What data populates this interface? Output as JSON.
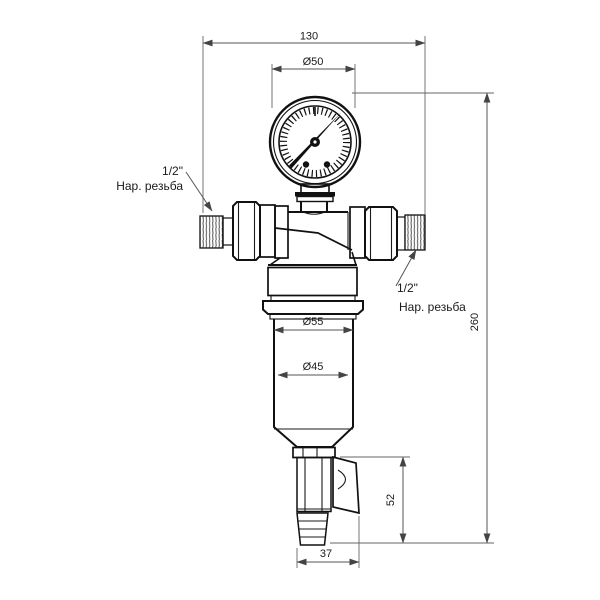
{
  "dimensions": {
    "overall_width": "130",
    "gauge_diameter": "Ø50",
    "overall_height": "260",
    "collar_diameter": "Ø55",
    "bowl_diameter": "Ø45",
    "drain_section_height": "52",
    "drain_section_width": "37"
  },
  "labels": {
    "left_connection": {
      "size": "1/2\"",
      "thread": "Нар. резьба"
    },
    "right_connection": {
      "size": "1/2\"",
      "thread": "Нар. резьба"
    }
  },
  "colors": {
    "background": "#ffffff",
    "outline": "#111111",
    "dimension_line": "#555555",
    "text": "#1a1a1a"
  }
}
